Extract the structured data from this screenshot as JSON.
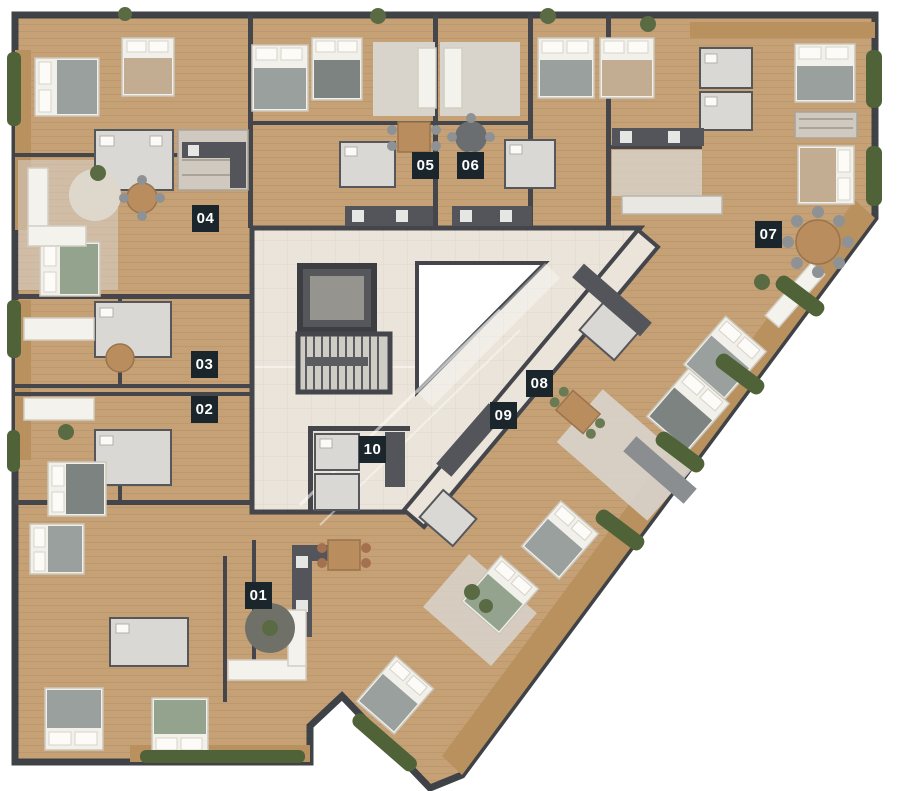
{
  "page": {
    "type": "architectural-floor-plan",
    "background": "#ffffff"
  },
  "units": [
    {
      "label": "01"
    },
    {
      "label": "02"
    },
    {
      "label": "03"
    },
    {
      "label": "04"
    },
    {
      "label": "05"
    },
    {
      "label": "06"
    },
    {
      "label": "07"
    },
    {
      "label": "08"
    },
    {
      "label": "09"
    },
    {
      "label": "10"
    }
  ],
  "badge": {
    "bg": "#1b262c",
    "text_color": "#ffffff"
  },
  "colors": {
    "wall": "#44464b",
    "wood_floor": "#c7a176",
    "balcony_wood": "#b9915f",
    "hall_tile": "#eae4da",
    "bath_tile": "#d9d8d4",
    "living_tile": "#d8d4cc",
    "hedge_green": "#4f6238",
    "furniture_white": "#f2f0ea",
    "lightwell": "#ffffff"
  }
}
